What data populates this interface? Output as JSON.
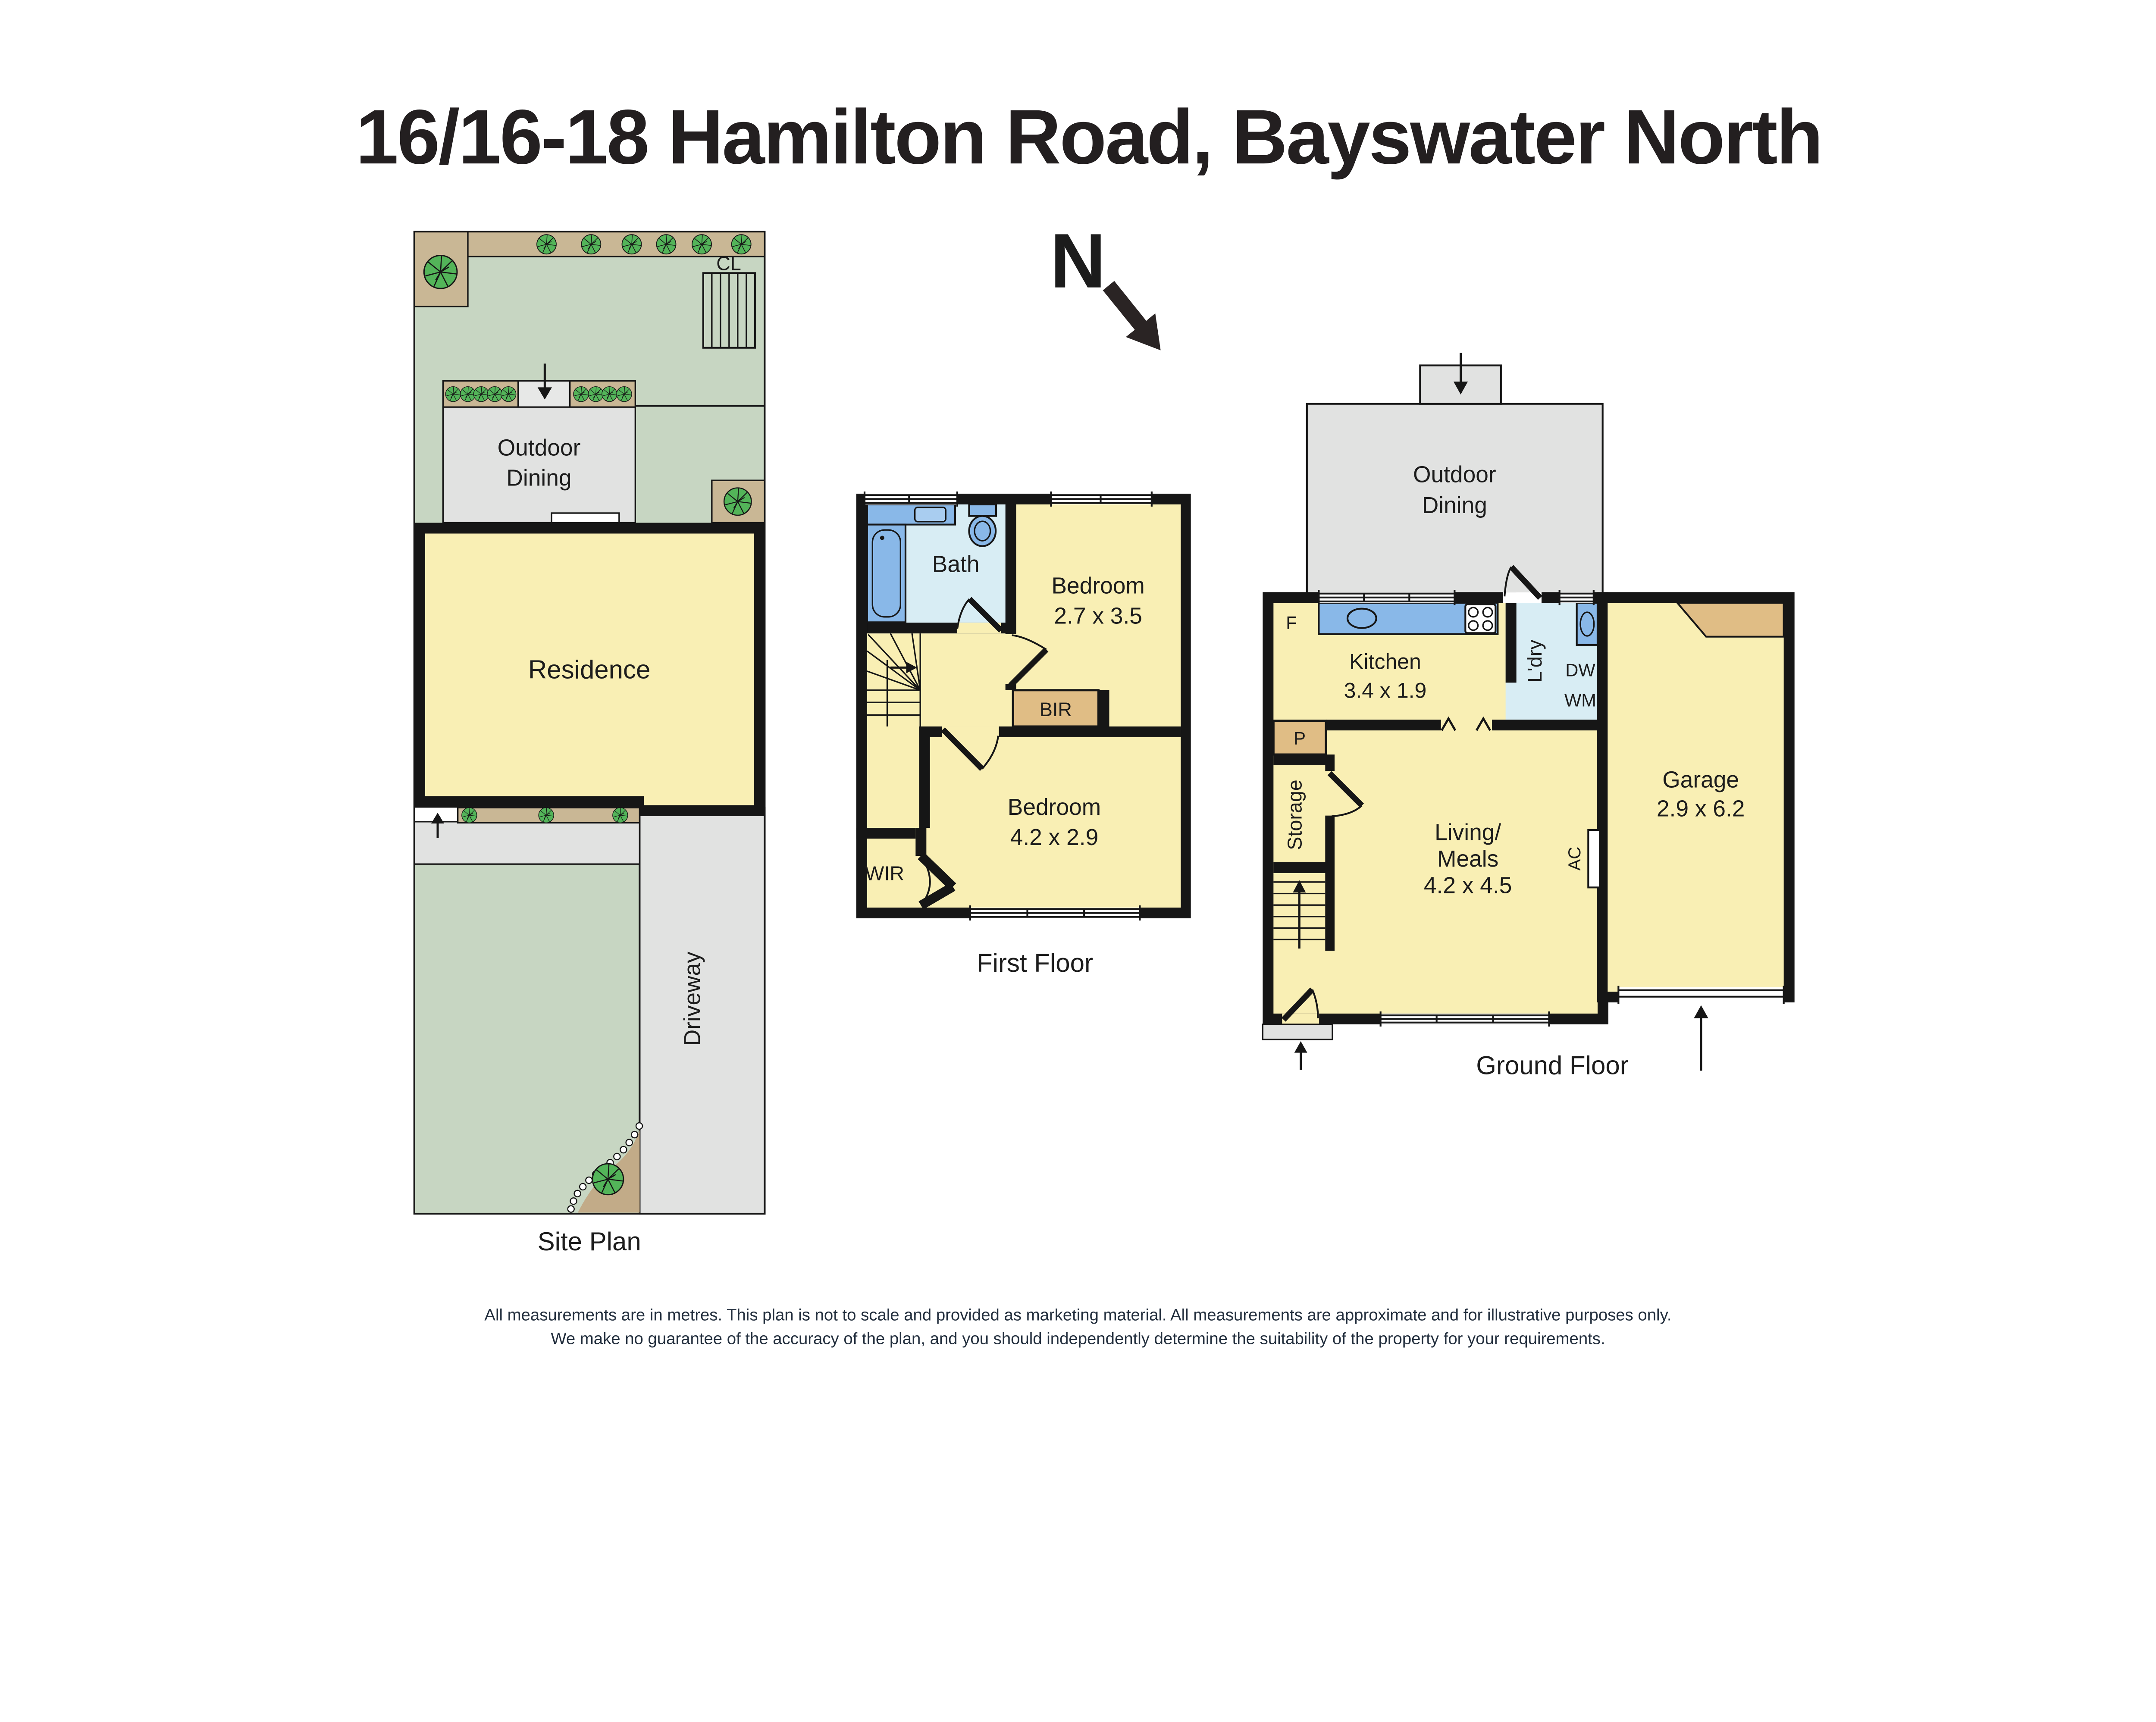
{
  "title": "16/16-18 Hamilton Road, Bayswater North",
  "north": {
    "label": "N"
  },
  "site_plan": {
    "label": "Site Plan",
    "clothesline": "CL",
    "outdoor_dining_line1": "Outdoor",
    "outdoor_dining_line2": "Dining",
    "residence": "Residence",
    "driveway": "Driveway"
  },
  "first_floor": {
    "label": "First Floor",
    "bath": "Bath",
    "bedroom1": {
      "name": "Bedroom",
      "dims": "2.7 x 3.5"
    },
    "bedroom2": {
      "name": "Bedroom",
      "dims": "4.2 x 2.9"
    },
    "bir": "BIR",
    "wir": "WIR"
  },
  "ground_floor": {
    "label": "Ground Floor",
    "outdoor_dining_line1": "Outdoor",
    "outdoor_dining_line2": "Dining",
    "fridge": "F",
    "kitchen": {
      "name": "Kitchen",
      "dims": "3.4 x 1.9"
    },
    "laundry": "L'dry",
    "dishwasher": "DW",
    "washing_machine": "WM",
    "pantry": "P",
    "storage": "Storage",
    "living": {
      "line1": "Living/",
      "line2": "Meals",
      "dims": "4.2 x 4.5"
    },
    "ac": "AC",
    "garage": {
      "name": "Garage",
      "dims": "2.9 x 6.2"
    }
  },
  "disclaimer": {
    "line1": "All measurements are in metres. This plan is not to scale and provided as marketing material. All measurements are approximate and for illustrative purposes only.",
    "line2": "We make no guarantee of the accuracy of the plan, and you should independently determine the suitability of the property for your requirements."
  },
  "colors": {
    "lawn": "#c7d6c2",
    "garden_tan": "#c9b795",
    "bed_tan": "#c2ab88",
    "paving_grey": "#e1e2e1",
    "floor_yellow": "#f9efb4",
    "wet_floor_blue": "#d8edf4",
    "fixture_blue": "#89b8e8",
    "robe_tan": "#e0bd85",
    "tree_green": "#53b459",
    "wall_black": "#161616"
  }
}
